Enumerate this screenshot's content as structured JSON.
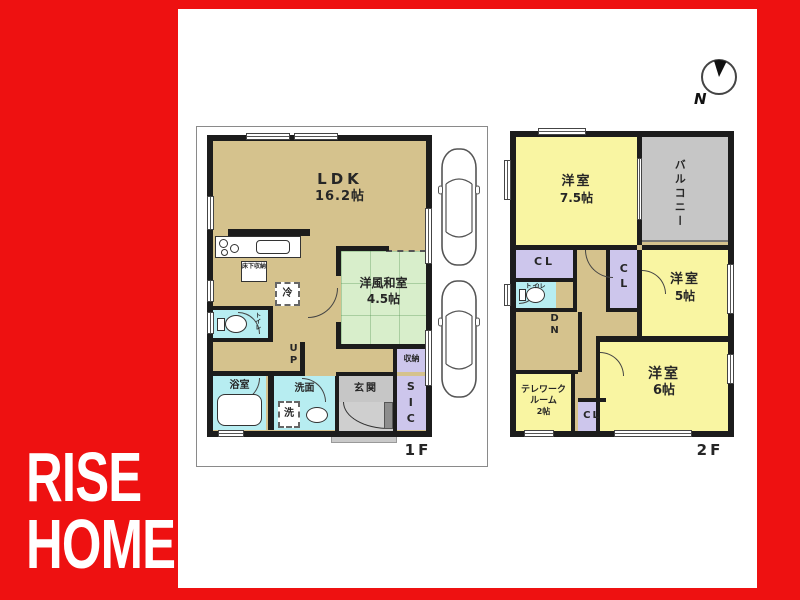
{
  "brand": {
    "line1": "RISE",
    "line2": "HOME"
  },
  "compass": {
    "north_label": "N"
  },
  "colors": {
    "accent_red": "#ee1111",
    "floor_tan": "#d5c28d",
    "tatami_green": "#d8eecb",
    "room_yellow": "#f9f5a2",
    "closet_lavender": "#cdc6ec",
    "wet_cyan": "#b7edf1",
    "balcony_gray": "#c6c6c6",
    "wall_black": "#1c1c1c"
  },
  "floor1": {
    "label": "1F",
    "ldk_name": "LDK",
    "ldk_size": "16.2帖",
    "washitsu_name": "洋風和室",
    "washitsu_size": "4.5帖",
    "underfloor_storage": "床下収納",
    "fridge": "冷",
    "stairs_up": "UP",
    "toilet": "トイレ",
    "bath": "浴室",
    "washroom": "洗面",
    "laundry": "洗",
    "entrance": "玄関",
    "shoe_closet": "SIC",
    "storage": "収納"
  },
  "floor2": {
    "label": "2F",
    "room75_name": "洋室",
    "room75_size": "7.5帖",
    "balcony": "バルコニー",
    "closet_a": "CL",
    "closet_b": "CL",
    "closet_c": "CL",
    "toilet": "トイレ",
    "stairs_down": "DN",
    "room5_name": "洋室",
    "room5_size": "5帖",
    "room6_name": "洋室",
    "room6_size": "6帖",
    "telework_line1": "テレワーク",
    "telework_line2": "ルーム",
    "telework_line3": "2帖"
  }
}
